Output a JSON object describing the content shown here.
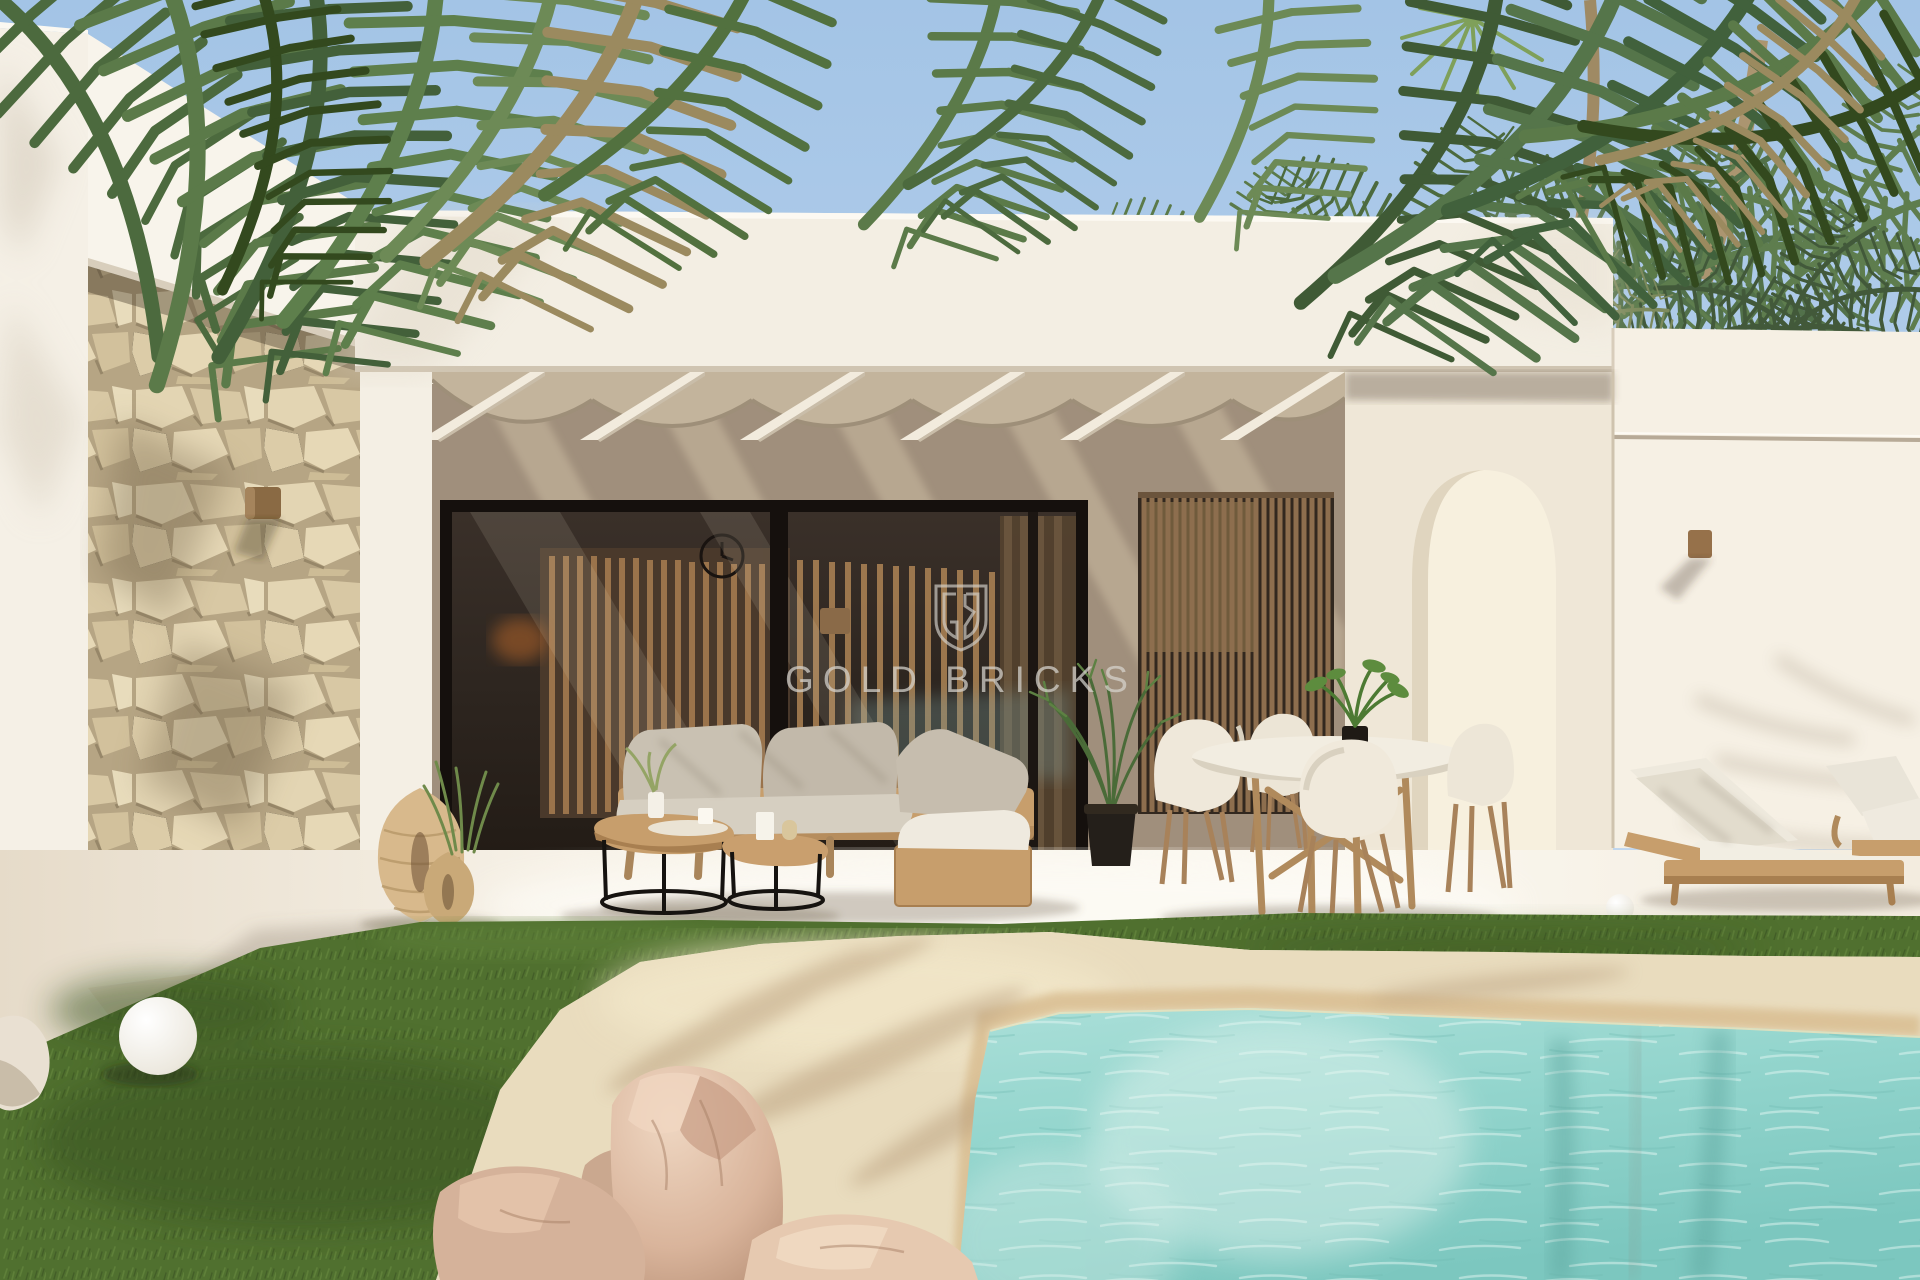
{
  "scene": {
    "type": "architectural-exterior-render",
    "description": "Modern white single-storey villa with covered terrace, natural stone feature wall, outdoor lounge and dining furniture, sun loungers, lawn and a sand-edged turquoise pool framed by palm trees",
    "watermark": {
      "text": "GOLD BRICKS",
      "monogram": "GB",
      "logo": "shield-monogram"
    }
  },
  "colors": {
    "sky-top": "#a3c4e6",
    "sky-bottom": "#cfe0f2",
    "wall-lit": "#f5f0e6",
    "wall-bright": "#f8f4eb",
    "wall-shade": "#e2d9ca",
    "facade": "#f3eee3",
    "terrace-wall": "#a08f7c",
    "terrace-stripe": "#cbbba1",
    "pergola": "#f0e9dc",
    "shade-fabric": "#c3b49c",
    "glass": "#2e2620",
    "frame": "#15100d",
    "slat-wood": "#8d6e4e",
    "stone-light": "#e4d6b4",
    "stone-mid": "#d3c29c",
    "stone-dark": "#8a7a5c",
    "grass": "#50702f",
    "grass-dark": "#3a5422",
    "grass-light": "#61823a",
    "sand": "#e9dcbe",
    "sand-wet": "#d9be92",
    "water": "#93d5cd",
    "water-deep": "#7cc7bf",
    "water-light": "#c9ece6",
    "wood": "#c79e6c",
    "cushion": "#c9c1b2",
    "cushion-light": "#efeadf",
    "watermark": "#d8d5cf"
  }
}
